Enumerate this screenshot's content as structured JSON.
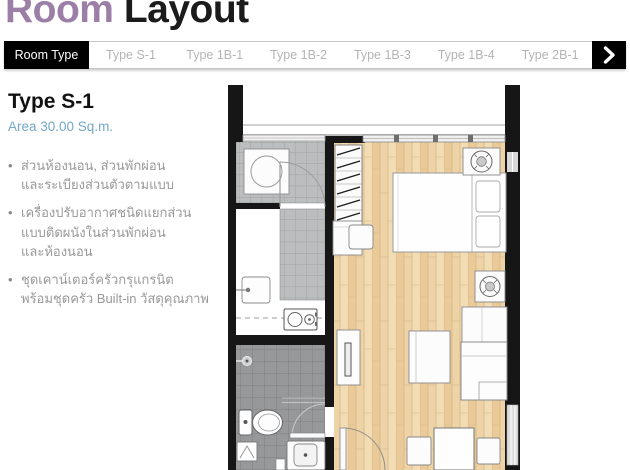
{
  "header": {
    "title_accent": "Room",
    "title_rest": " Layout"
  },
  "nav": {
    "active_tab": "Room Type",
    "tabs": [
      "Type S-1",
      "Type 1B-1",
      "Type 1B-2",
      "Type 1B-3",
      "Type 1B-4",
      "Type 2B-1"
    ],
    "icons": {
      "next_arrow": "chevron-right"
    }
  },
  "unit": {
    "name": "Type S-1",
    "area_label": "Area 30.00 Sq.m.",
    "features": [
      "ส่วนห้องนอน, ส่วนพักผ่อน\nและระเบียงส่วนตัวตามแบบ",
      "เครื่องปรับอากาศชนิดแยกส่วน\nแบบติดผนังในส่วนพักผ่อน\nและห้องนอน",
      "ชุดเคาน์เตอร์ครัวกรุแกรนิต\nพร้อมชุดครัว Built-in วัสดุคุณภาพ"
    ]
  },
  "colors": {
    "title_accent": "#9c7fa6",
    "area_text": "#72a7c7",
    "nav_inactive_text": "#b4b4b4",
    "wall": "#161616",
    "wood_floor": "#edd3a6",
    "tile_light": "#bbbdbe",
    "tile_dark": "#96989a"
  }
}
